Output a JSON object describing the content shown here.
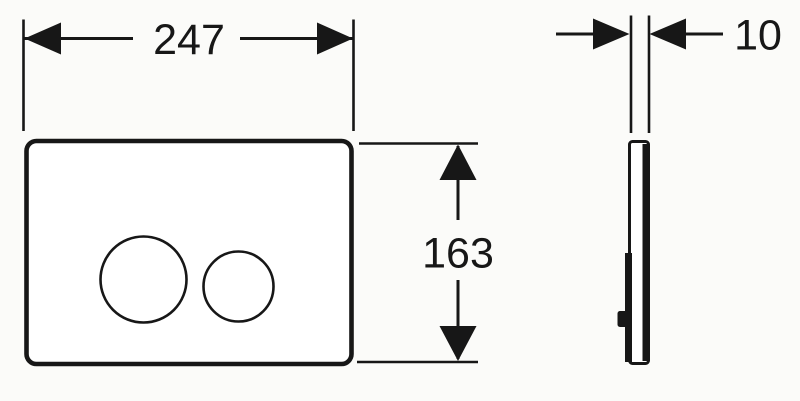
{
  "drawing": {
    "description": "flush-plate dimensional drawing, front view and side profile",
    "background_color": "#fbfbf9",
    "ink_color": "#171717",
    "plate_fill": "#ffffff",
    "views": {
      "front_view_label": "front view with two round flush buttons",
      "side_view_label": "side profile with mounting tab"
    },
    "dimensions": {
      "width": {
        "value": "247"
      },
      "height": {
        "value": "163"
      },
      "depth": {
        "value": "10"
      }
    }
  }
}
